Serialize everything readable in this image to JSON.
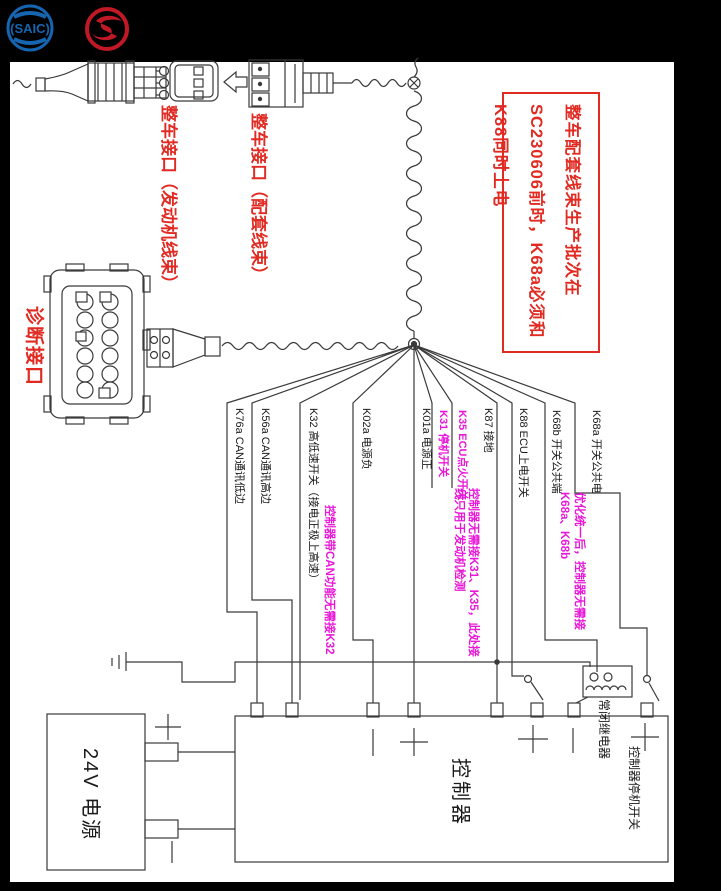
{
  "palette": {
    "background": "#000000",
    "paper": "#ffffff",
    "line": "#3a3a3a",
    "red_accent": "#e02a22",
    "magenta_accent": "#e818d8",
    "saic_blue": "#1565b0",
    "sunwin_red": "#c01825"
  },
  "logos": {
    "saic_text": "SAIC"
  },
  "warning_box": {
    "text": "整车配套线束生产批次在SC230606前时，K68a必须和K88同时上电"
  },
  "connector_labels": {
    "vehicle_engine": "整车接口（发动机线束）",
    "vehicle_matching": "整车接口（配套线束）",
    "diagnostic": "诊断接口"
  },
  "wires": [
    {
      "code": "K76a",
      "label": "K76a CAN通讯低边",
      "color": "black"
    },
    {
      "code": "K56a",
      "label": "K56a CAN通讯高边",
      "color": "black"
    },
    {
      "code": "K32",
      "label": "K32 高低速开关（接电正极上高速）",
      "color": "black"
    },
    {
      "code": "K02a",
      "label": "K02a 电源负",
      "color": "black"
    },
    {
      "code": "K01a",
      "label": "K01a 电源正",
      "color": "black"
    },
    {
      "code": "K31",
      "label": "K31 停机开关",
      "color": "magenta"
    },
    {
      "code": "K35",
      "label": "K35 ECU点火开关",
      "color": "magenta"
    },
    {
      "code": "K87",
      "label": "K87 接地",
      "color": "black"
    },
    {
      "code": "K88",
      "label": "K88 ECU上电开关",
      "color": "black"
    },
    {
      "code": "K68b",
      "label": "K68b 开关公共端",
      "color": "black"
    },
    {
      "code": "K68a",
      "label": "K68a 开关公共电",
      "color": "black"
    }
  ],
  "notes": [
    {
      "text": "控制器带CAN功能无需接K32"
    },
    {
      "text": "控制器无需接K31、K35，此处接线只用于发动机检测"
    },
    {
      "text": "优化统一后，控制器无需接K68a、K68b"
    }
  ],
  "controller": {
    "label": "控制器",
    "relay_label": "常闭继电器",
    "stop_switch_label": "控制器停机开关",
    "plus": "+",
    "minus": "−"
  },
  "power": {
    "label": "24V 电源"
  }
}
